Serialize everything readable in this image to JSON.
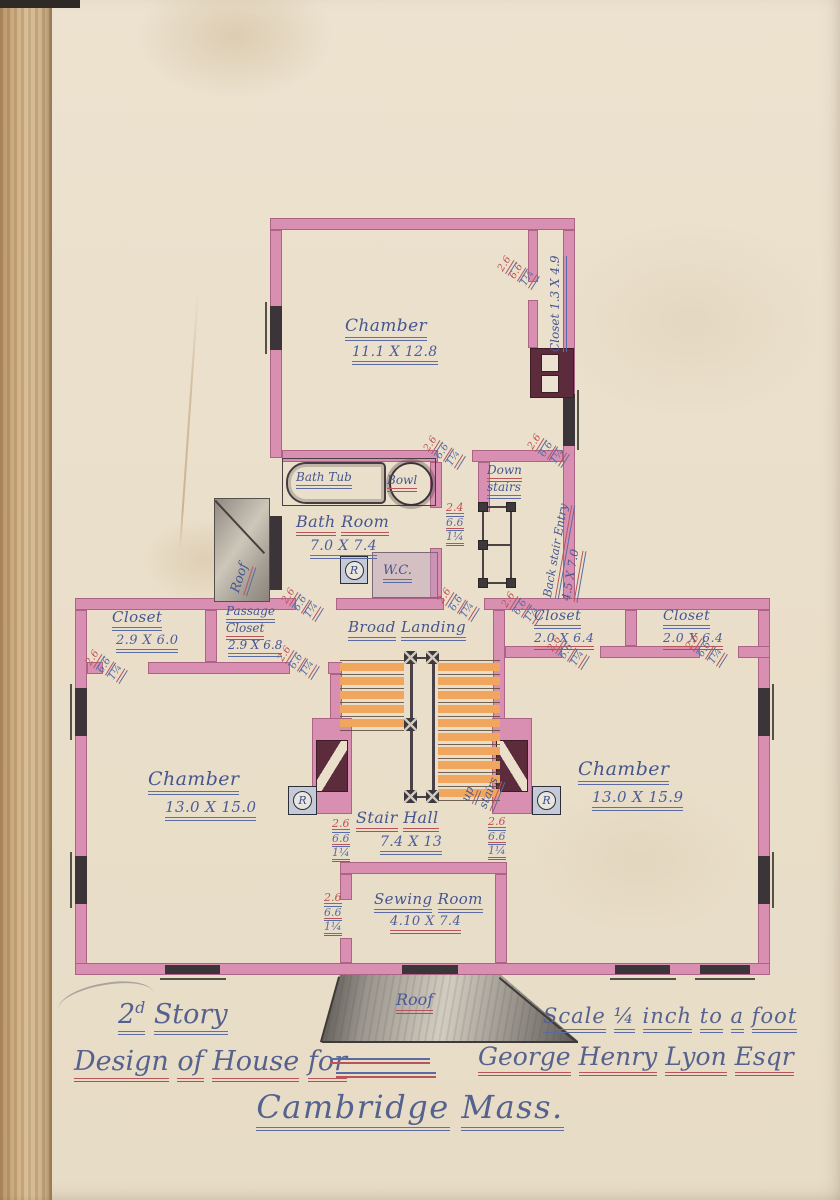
{
  "title_block": {
    "story_num": "2",
    "story_sup": "d",
    "story_word": "Story",
    "scale": "Scale ¼ inch to a foot",
    "design_prefix": "Design of House for",
    "client": "George Henry Lyon Esqr",
    "city": "Cambridge Mass."
  },
  "rooms": {
    "chamber_top": {
      "name": "Chamber",
      "dims": "11.1 X 12.8"
    },
    "closet_top_right": {
      "label": "Closet 1.3 X 4.9"
    },
    "bath_room": {
      "name": "Bath Room",
      "dims": "7.0 X 7.4"
    },
    "back_stair": {
      "name": "Back stair Entry",
      "dims": "4.5 X 7.0"
    },
    "closet_left": {
      "name": "Closet",
      "dims": "2.9 X 6.0"
    },
    "passage_closet": {
      "line1": "Passage",
      "line2": "Closet",
      "dims": "2.9 X 6.8"
    },
    "broad_landing": {
      "name": "Broad Landing"
    },
    "closet_right_1": {
      "name": "Closet",
      "dims": "2.0 X 6.4"
    },
    "closet_right_2": {
      "name": "Closet",
      "dims": "2.0 X 6.4"
    },
    "chamber_left": {
      "name": "Chamber",
      "dims": "13.0 X 15.0"
    },
    "chamber_right": {
      "name": "Chamber",
      "dims": "13.0 X 15.9"
    },
    "stair_hall": {
      "name": "Stair Hall",
      "dims": "7.4 X 13"
    },
    "sewing_room": {
      "name": "Sewing Room",
      "dims": "4.10 X 7.4"
    }
  },
  "fixtures": {
    "bath_tub": "Bath Tub",
    "bowl": "Bowl",
    "wc": "W.C.",
    "register_letter": "R",
    "down_line1": "Down",
    "down_line2": "stairs",
    "up_line1": "up",
    "up_line2": "stairs",
    "roof_small": "Roof",
    "roof_porch": "Roof"
  },
  "door_dim": {
    "w": "2.6",
    "h": "6.6",
    "t": "1¼"
  },
  "door_dim_alt": {
    "w": "2.4"
  },
  "colors": {
    "wall_pink": "#d98fb2",
    "chimney": "#5d2c3c",
    "stair_orange": "#f1a65e",
    "ink_blue": "#46568f",
    "ink_red": "#c05052",
    "paper": "#eadfca"
  }
}
